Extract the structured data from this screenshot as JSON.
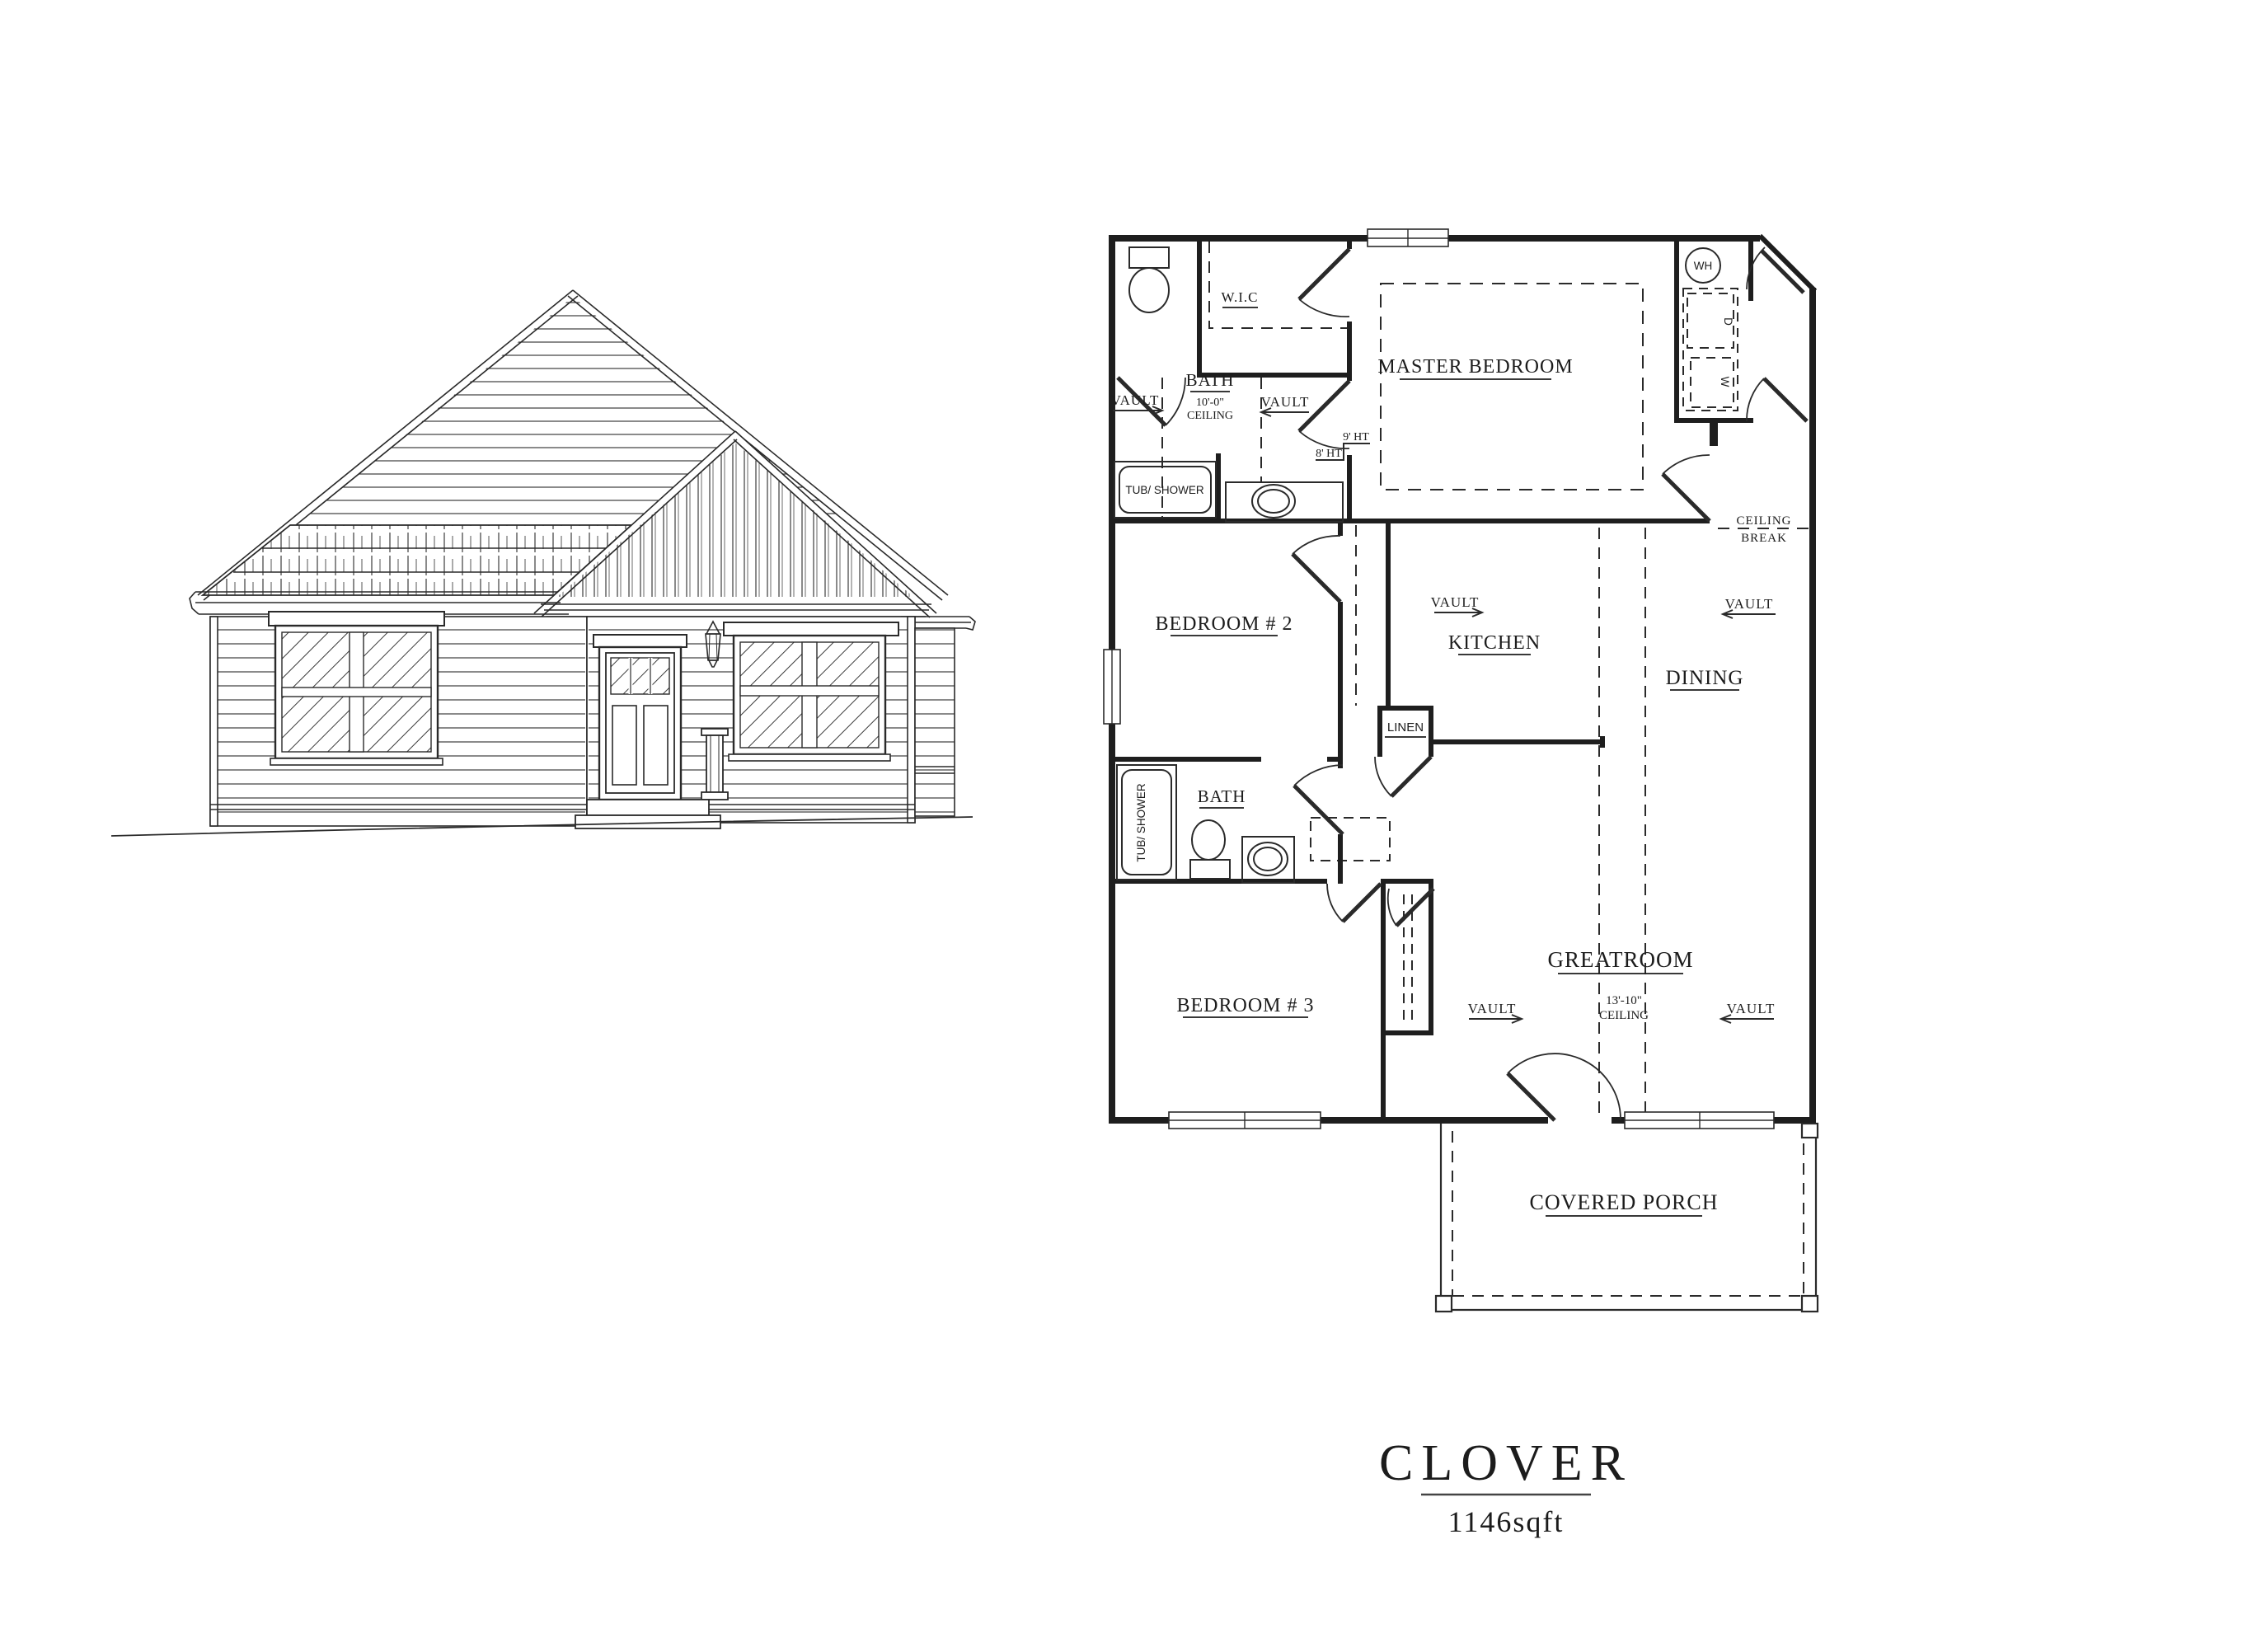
{
  "page": {
    "background": "#ffffff",
    "line_color": "#2a2a2a",
    "text_color": "#1c1c1c"
  },
  "title_block": {
    "plan_name": "CLOVER",
    "area": "1146sqft"
  },
  "floor_plan": {
    "rooms": {
      "wic": "W.I.C",
      "master_bedroom": "MASTER BEDROOM",
      "bath_master": "BATH",
      "bedroom_2": "BEDROOM # 2",
      "kitchen": "KITCHEN",
      "dining": "DINING",
      "bath_2": "BATH",
      "bedroom_3": "BEDROOM # 3",
      "greatroom": "GREATROOM",
      "linen": "LINEN",
      "covered_porch": "COVERED PORCH"
    },
    "annotations": {
      "vault": "VAULT",
      "ceiling_10": "10'-0\"",
      "ceiling_word": "CEILING",
      "ceiling_13_10": "13'-10\"",
      "ceiling_break_line1": "CEILING",
      "ceiling_break_line2": "BREAK",
      "ht_8": "8' HT",
      "ht_9": "9' HT"
    },
    "fixtures": {
      "water_heater": "WH",
      "dryer": "D",
      "washer": "W",
      "tub_shower": "TUB/ SHOWER"
    }
  }
}
